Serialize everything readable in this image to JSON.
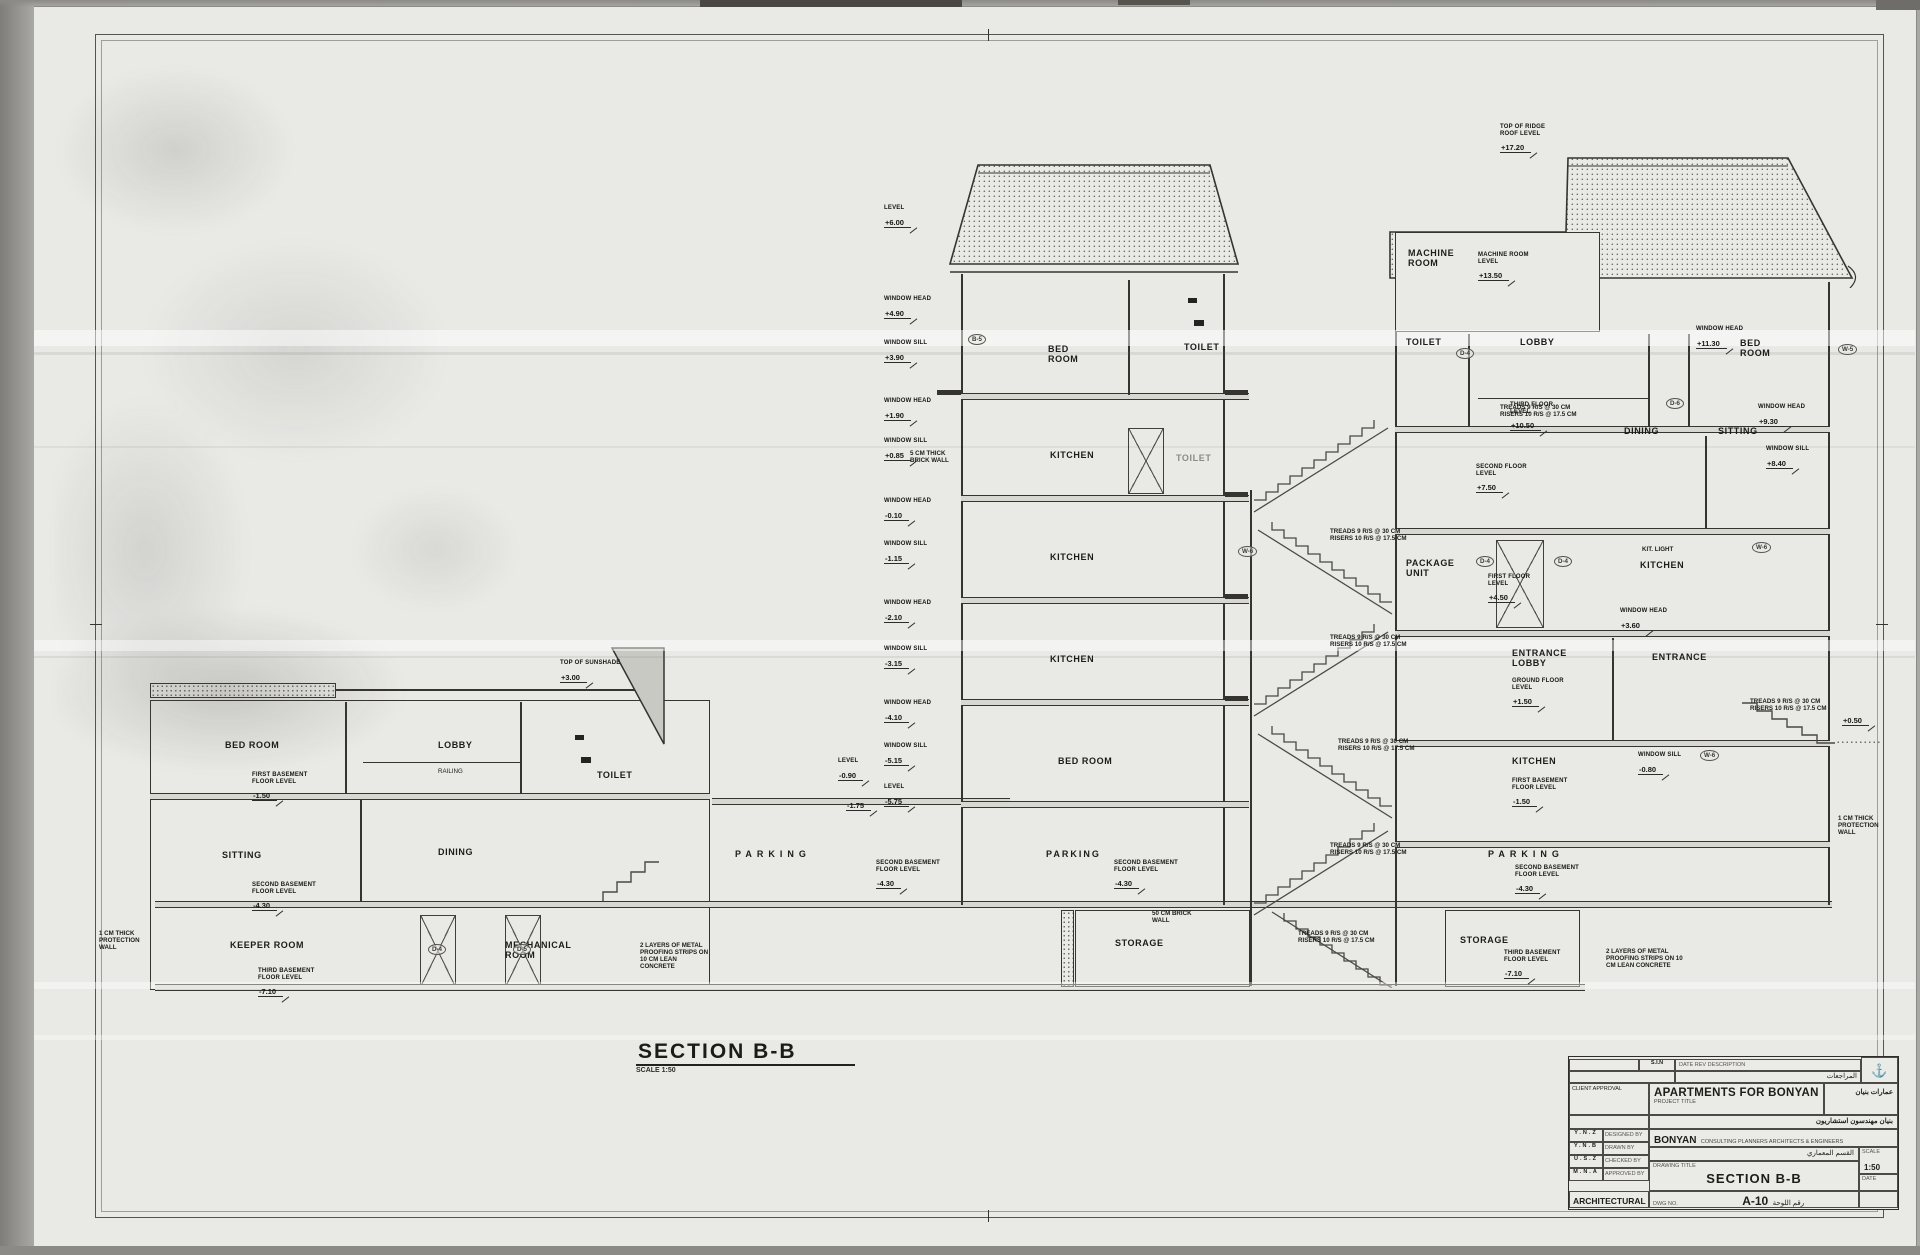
{
  "sheet": {
    "section_title": "SECTION B-B",
    "section_scale": "SCALE 1:50"
  },
  "levels_column": [
    {
      "cap": "LEVEL",
      "val": "+6.00"
    },
    {
      "cap": "WINDOW HEAD",
      "val": "+4.90"
    },
    {
      "cap": "WINDOW SILL",
      "val": "+3.90"
    },
    {
      "cap": "WINDOW HEAD",
      "val": "+1.90"
    },
    {
      "cap": "WINDOW SILL",
      "val": "+0.85"
    },
    {
      "cap": "WINDOW HEAD",
      "val": "-0.10"
    },
    {
      "cap": "WINDOW SILL",
      "val": "-1.15"
    },
    {
      "cap": "WINDOW HEAD",
      "val": "-2.10"
    },
    {
      "cap": "WINDOW SILL",
      "val": "-3.15"
    },
    {
      "cap": "WINDOW HEAD",
      "val": "-4.10"
    },
    {
      "cap": "WINDOW SILL",
      "val": "-5.15"
    },
    {
      "cap": "LEVEL",
      "val": "-5.75"
    }
  ],
  "rooms": {
    "left": {
      "bed_room": "BED ROOM",
      "lobby": "LOBBY",
      "toilet": "TOILET",
      "sitting": "SITTING",
      "dining": "DINING",
      "keeper_room": "KEEPER ROOM",
      "mechanical_room": "MECHANICAL\nROOM",
      "parking": "PARKING"
    },
    "middle": {
      "bed_room": "BED\nROOM",
      "toilet": "TOILET",
      "kitchen_2": "KITCHEN",
      "toilet_2": "TOILET",
      "kitchen_1": "KITCHEN",
      "kitchen_g": "KITCHEN",
      "bed_room_b": "BED ROOM",
      "parking": "PARKING",
      "storage": "STORAGE"
    },
    "right": {
      "machine_room": "MACHINE\nROOM",
      "toilet": "TOILET",
      "lobby": "LOBBY",
      "bed_room": "BED\nROOM",
      "dining": "DINING",
      "sitting": "SITTING",
      "package_unit": "PACKAGE\nUNIT",
      "kitchen_1": "KITCHEN",
      "entrance_lobby": "ENTRANCE\nLOBBY",
      "entrance": "ENTRANCE",
      "kitchen_g": "KITCHEN",
      "parking": "PARKING",
      "storage": "STORAGE"
    }
  },
  "annotations": {
    "ridge": {
      "cap": "TOP OF RIDGE ROOF LEVEL",
      "val": "+17.20"
    },
    "machine": {
      "cap": "MACHINE ROOM LEVEL",
      "val": "+13.50"
    },
    "third": {
      "cap": "THIRD FLOOR LEVEL",
      "val": "+10.50"
    },
    "head3": {
      "cap": "WINDOW HEAD",
      "val": "+11.30"
    },
    "second": {
      "cap": "SECOND FLOOR LEVEL",
      "val": "+7.50"
    },
    "head2": {
      "cap": "WINDOW HEAD",
      "val": "+9.30"
    },
    "sill2": {
      "cap": "WINDOW SILL",
      "val": "+8.40"
    },
    "first": {
      "cap": "FIRST FLOOR LEVEL",
      "val": "+4.50"
    },
    "head1": {
      "cap": "WINDOW HEAD",
      "val": "+3.60"
    },
    "ground": {
      "cap": "GROUND FLOOR LEVEL",
      "val": "+1.50"
    },
    "grade": {
      "cap": "",
      "val": "+0.50"
    },
    "sillb1": {
      "cap": "WINDOW SILL",
      "val": "-0.80"
    },
    "b1": {
      "cap": "FIRST BASEMENT FLOOR LEVEL",
      "val": "-1.50"
    },
    "b2": {
      "cap": "SECOND BASEMENT FLOOR LEVEL",
      "val": "-4.30"
    },
    "b3": {
      "cap": "THIRD BASEMENT FLOOR LEVEL",
      "val": "-7.10"
    },
    "sunshade": {
      "cap": "TOP OF SUNSHADE",
      "val": "+3.00"
    },
    "lvl090": {
      "cap": "LEVEL",
      "val": "-0.90"
    },
    "lvl175": {
      "cap": "",
      "val": "-1.75"
    },
    "stair": {
      "l1": "TREADS 9 R/S @ 30 CM",
      "l2": "RISERS 10 R/S @ 17.5 CM"
    },
    "brick5": "5 CM THICK BRICK WALL",
    "brick50": "50 CM BRICK WALL",
    "protection": "1 CM THICK PROTECTION WALL",
    "proofing": "2 LAYERS OF METAL PROOFING STRIPS ON 10 CM LEAN CONCRETE",
    "kitlight": "KIT. LIGHT",
    "railing": "RAILING"
  },
  "tags": {
    "d4": "D-4",
    "d5": "D-5",
    "d6": "D-6",
    "w5": "W-5",
    "w6": "W-6",
    "b5": "B-5"
  },
  "title_block": {
    "rev_code": "S.I.N",
    "rev_header": "DATE      REV      DESCRIPTION",
    "rev_ar": "المراجعات",
    "approval_label": "CLIENT APPROVAL",
    "project_title": "APARTMENTS FOR BONYAN",
    "project_title_label": "PROJECT TITLE",
    "project_ar": "عمارات بنيان",
    "firm_name": "BONYAN",
    "firm_sub": "CONSULTING PLANNERS ARCHITECTS & ENGINEERS",
    "firm_ar": "بنيان مهندسون استشاريون",
    "dept_ar": "القسم المعماري",
    "signatures": [
      {
        "code": "Y.N.Z",
        "role": "DESIGNED BY"
      },
      {
        "code": "Y.N.B",
        "role": "DRAWN BY"
      },
      {
        "code": "U.S.Z",
        "role": "CHECKED BY"
      },
      {
        "code": "M.N.A",
        "role": "APPROVED BY"
      }
    ],
    "discipline": "ARCHITECTURAL",
    "drawing_title_label": "DRAWING TITLE",
    "drawing_title": "SECTION B-B",
    "dwg_no_label": "DWG  NO.",
    "dwg_no": "A-10",
    "dwg_ar": "رقم اللوحة",
    "scale_label": "SCALE",
    "scale_value": "1:50",
    "date_label": "DATE"
  }
}
